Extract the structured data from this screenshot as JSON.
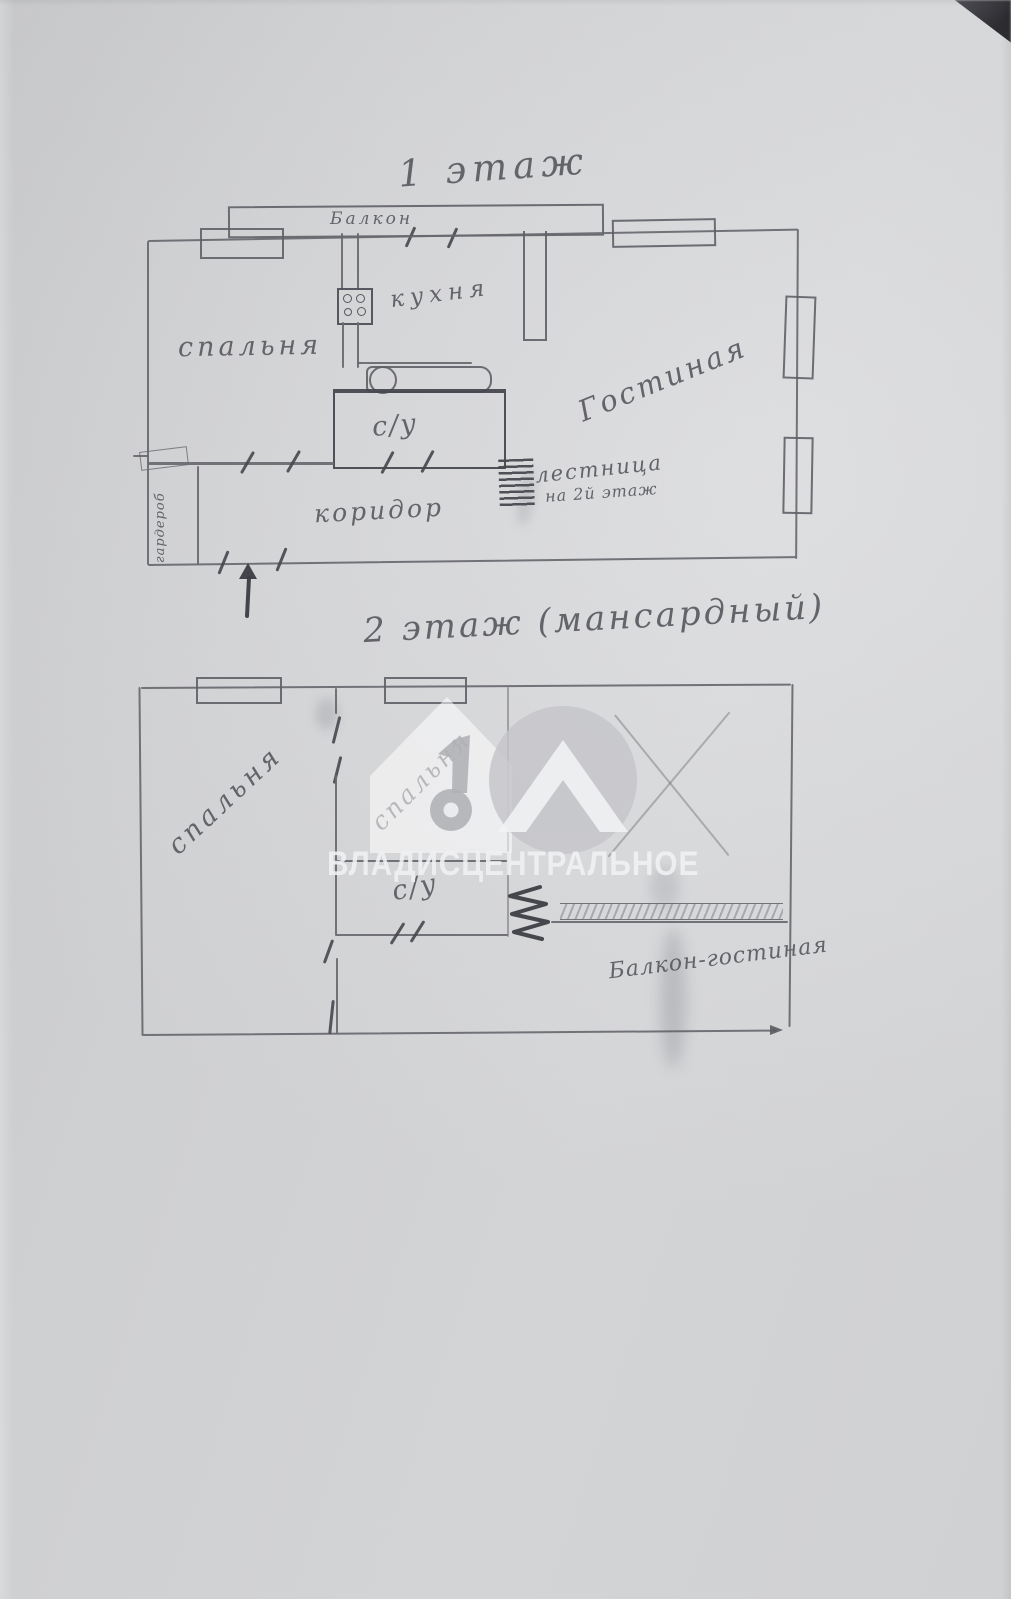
{
  "floor1": {
    "title": "1 этаж",
    "balcony_label": "Балкон",
    "bedroom_label": "спальня",
    "kitchen_label": "кухня",
    "living_room_label": "Гостиная",
    "bathroom_label": "с/у",
    "corridor_label": "коридор",
    "wardrobe_label": "гардероб",
    "stairs_label_line1": "лестница",
    "stairs_label_line2": "на 2й этаж"
  },
  "floor2": {
    "title": "2 этаж (мансардный)",
    "bedroom_left_label": "спальня",
    "bedroom_middle_label": "спальня",
    "bathroom_label": "с/у",
    "balcony_living_label": "Балкон-гостиная"
  },
  "watermark": {
    "text": "ВЛАДИСЦЕНТРАЛЬНОЕ",
    "logo": "house-with-number-10-and-key"
  },
  "symbols": {
    "stove": "gas-burners-icon",
    "bathtub": "bathtub-icon",
    "stairs_floor1": "stairs-hatch-icon",
    "stairs_floor2": "spring-stairs-icon",
    "entrance": "entrance-arrow-icon",
    "balcony_wall": "hatched-wall"
  },
  "colors": {
    "paper": "#d6d7d9",
    "pencil": "#68686f",
    "pencil_dark": "#4e4e56",
    "watermark": "rgba(240,241,243,0.88)"
  }
}
